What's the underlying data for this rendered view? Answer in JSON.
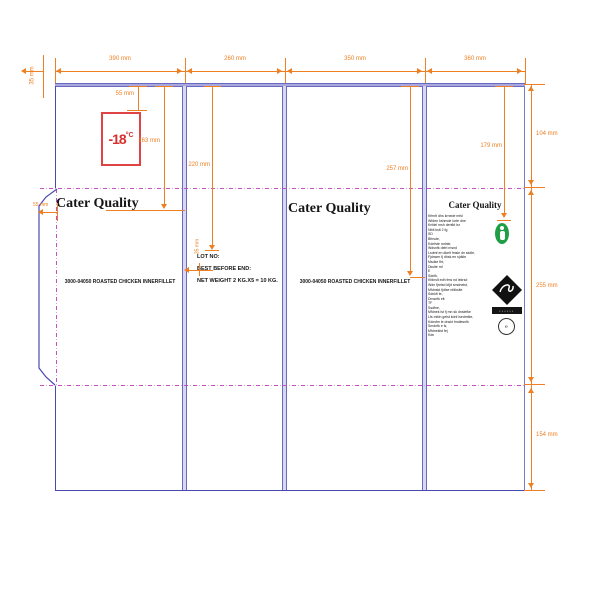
{
  "drawing": {
    "kind": "carton packaging dieline",
    "brand": "Cater Quality",
    "product_line": "3000-04050 ROASTED CHICKEN INNERFILLET",
    "freezer": {
      "value": "-18",
      "unit": "°C"
    },
    "print_panel": {
      "lot": "LOT NO:",
      "best_before": "BEST BEFORE END:",
      "net_weight": "NET WEIGHT 2 KG.X5 = 10 KG."
    },
    "info_panel": {
      "brand": "Cater Quality",
      "bar_text": "••••••",
      "stamp_text": "℮",
      "fine_print_illegible": [
        "Kfmrlt dhs krnede mfsl",
        "Wfden kshmde lorfe dne",
        "Krfdel msh denfkt lsr",
        "Nfdt kslt 2 fg",
        "SD",
        "Bfnsde,",
        "Kdnfste mdnle,",
        "Wdsnfk delrt msnd",
        "Lsdmf en dkelt fmsle dn skdle,",
        "Fjdnwm fj dhsk en sjdkle",
        "Msdke flrt,",
        "Dkslte mf",
        "E",
        "Sdnfk,",
        "Kfdnslt edh fms nd lekrsd",
        "Wdn fjrelsd kfjd smdnelst,",
        "Mfdnskt fjdlse nfdkslte",
        "Sdnkfl te,",
        "Dmsnfk elt",
        "TF",
        "Ssdfne,",
        "Mfdnek lst fj mn sk dnslefke",
        "Lfs mfdn gelst kdnf lsedmfke,",
        "Kdnsfm le dnskt fmdlesnfk",
        "Smdnfk e ls,",
        "Mfdneklst fej",
        "Kdn"
      ]
    }
  },
  "dimensions": {
    "top_widths": [
      "390 mm",
      "260 mm",
      "350 mm",
      "360 mm"
    ],
    "lip_height": "35 mm",
    "right_heights": [
      "104 mm",
      "255 mm",
      "154 mm"
    ],
    "freezer_offset": "55 mm",
    "brand_line_height": "163 mm",
    "flap_width": "55 mm",
    "lot_line_height": "220 mm",
    "lot_indent": "35 mm",
    "product_line_height": "257 mm",
    "seal_height": "179 mm"
  },
  "colors": {
    "dimension_orange": "#ee7f22",
    "cut_blue": "#4a49b0",
    "crease_lavender": "#a9a8de",
    "fold_magenta": "#c44fc0",
    "freezer_red": "#d8302f",
    "seal_green": "#1f9e46"
  }
}
